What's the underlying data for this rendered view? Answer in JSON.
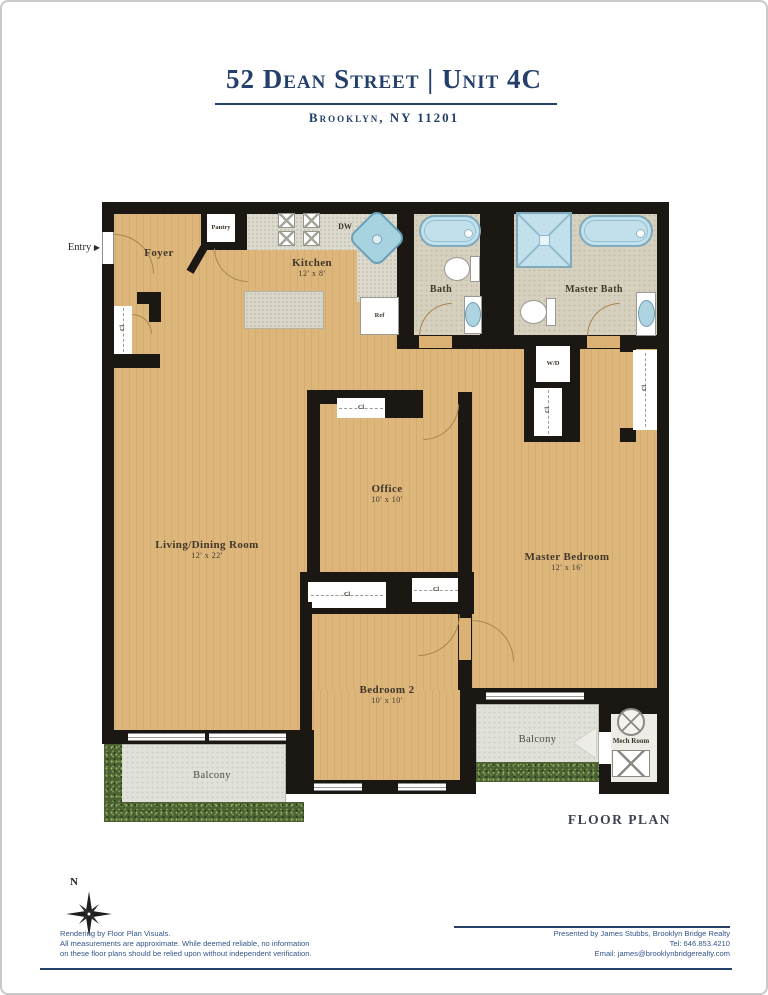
{
  "header": {
    "title": "52 Dean Street | Unit 4C",
    "subtitle": "Brooklyn, NY 11201"
  },
  "plan": {
    "entry_label": "Entry",
    "entry_arrow": "▶",
    "floor_plan_label": "FLOOR PLAN",
    "compass_north": "N",
    "rooms": {
      "foyer": {
        "name": "Foyer"
      },
      "kitchen": {
        "name": "Kitchen",
        "dims": "12' x 8'"
      },
      "bath": {
        "name": "Bath"
      },
      "master_bath": {
        "name": "Master Bath"
      },
      "office": {
        "name": "Office",
        "dims": "10' x 10'"
      },
      "living_dining": {
        "name": "Living/Dining Room",
        "dims": "12' x 22'"
      },
      "master_bedroom": {
        "name": "Master Bedroom",
        "dims": "12' x 16'"
      },
      "bedroom2": {
        "name": "Bedroom 2",
        "dims": "10' x 10'"
      },
      "balcony_left": {
        "name": "Balcony"
      },
      "balcony_right": {
        "name": "Balcony"
      },
      "mech_room": {
        "name": "Mech Room"
      }
    },
    "fixtures": {
      "pantry": "Pantry",
      "dishwasher": "DW",
      "refrigerator": "Ref",
      "washer_dryer": "W/D",
      "closet": "Cl"
    }
  },
  "footer": {
    "left": [
      "Rendering by Floor Plan Visuals.",
      "All measurements are approximate. While deemed reliable, no information",
      "on these floor plans should be relied upon without independent verification."
    ],
    "right": [
      "Presented by James Stubbs, Brooklyn Bridge Realty",
      "Tel: 646.853.4210",
      "Email: james@brooklynbridgerealty.com"
    ]
  },
  "colors": {
    "accent_navy": "#24406a",
    "floor_tan": "#dbb274",
    "wall_black": "#1b1713",
    "bath_tile": "#d6d0bf",
    "fixture_blue": "#c2e0ec",
    "balcony_gray": "#e0e1d8",
    "greenery_green": "#4c6134"
  }
}
